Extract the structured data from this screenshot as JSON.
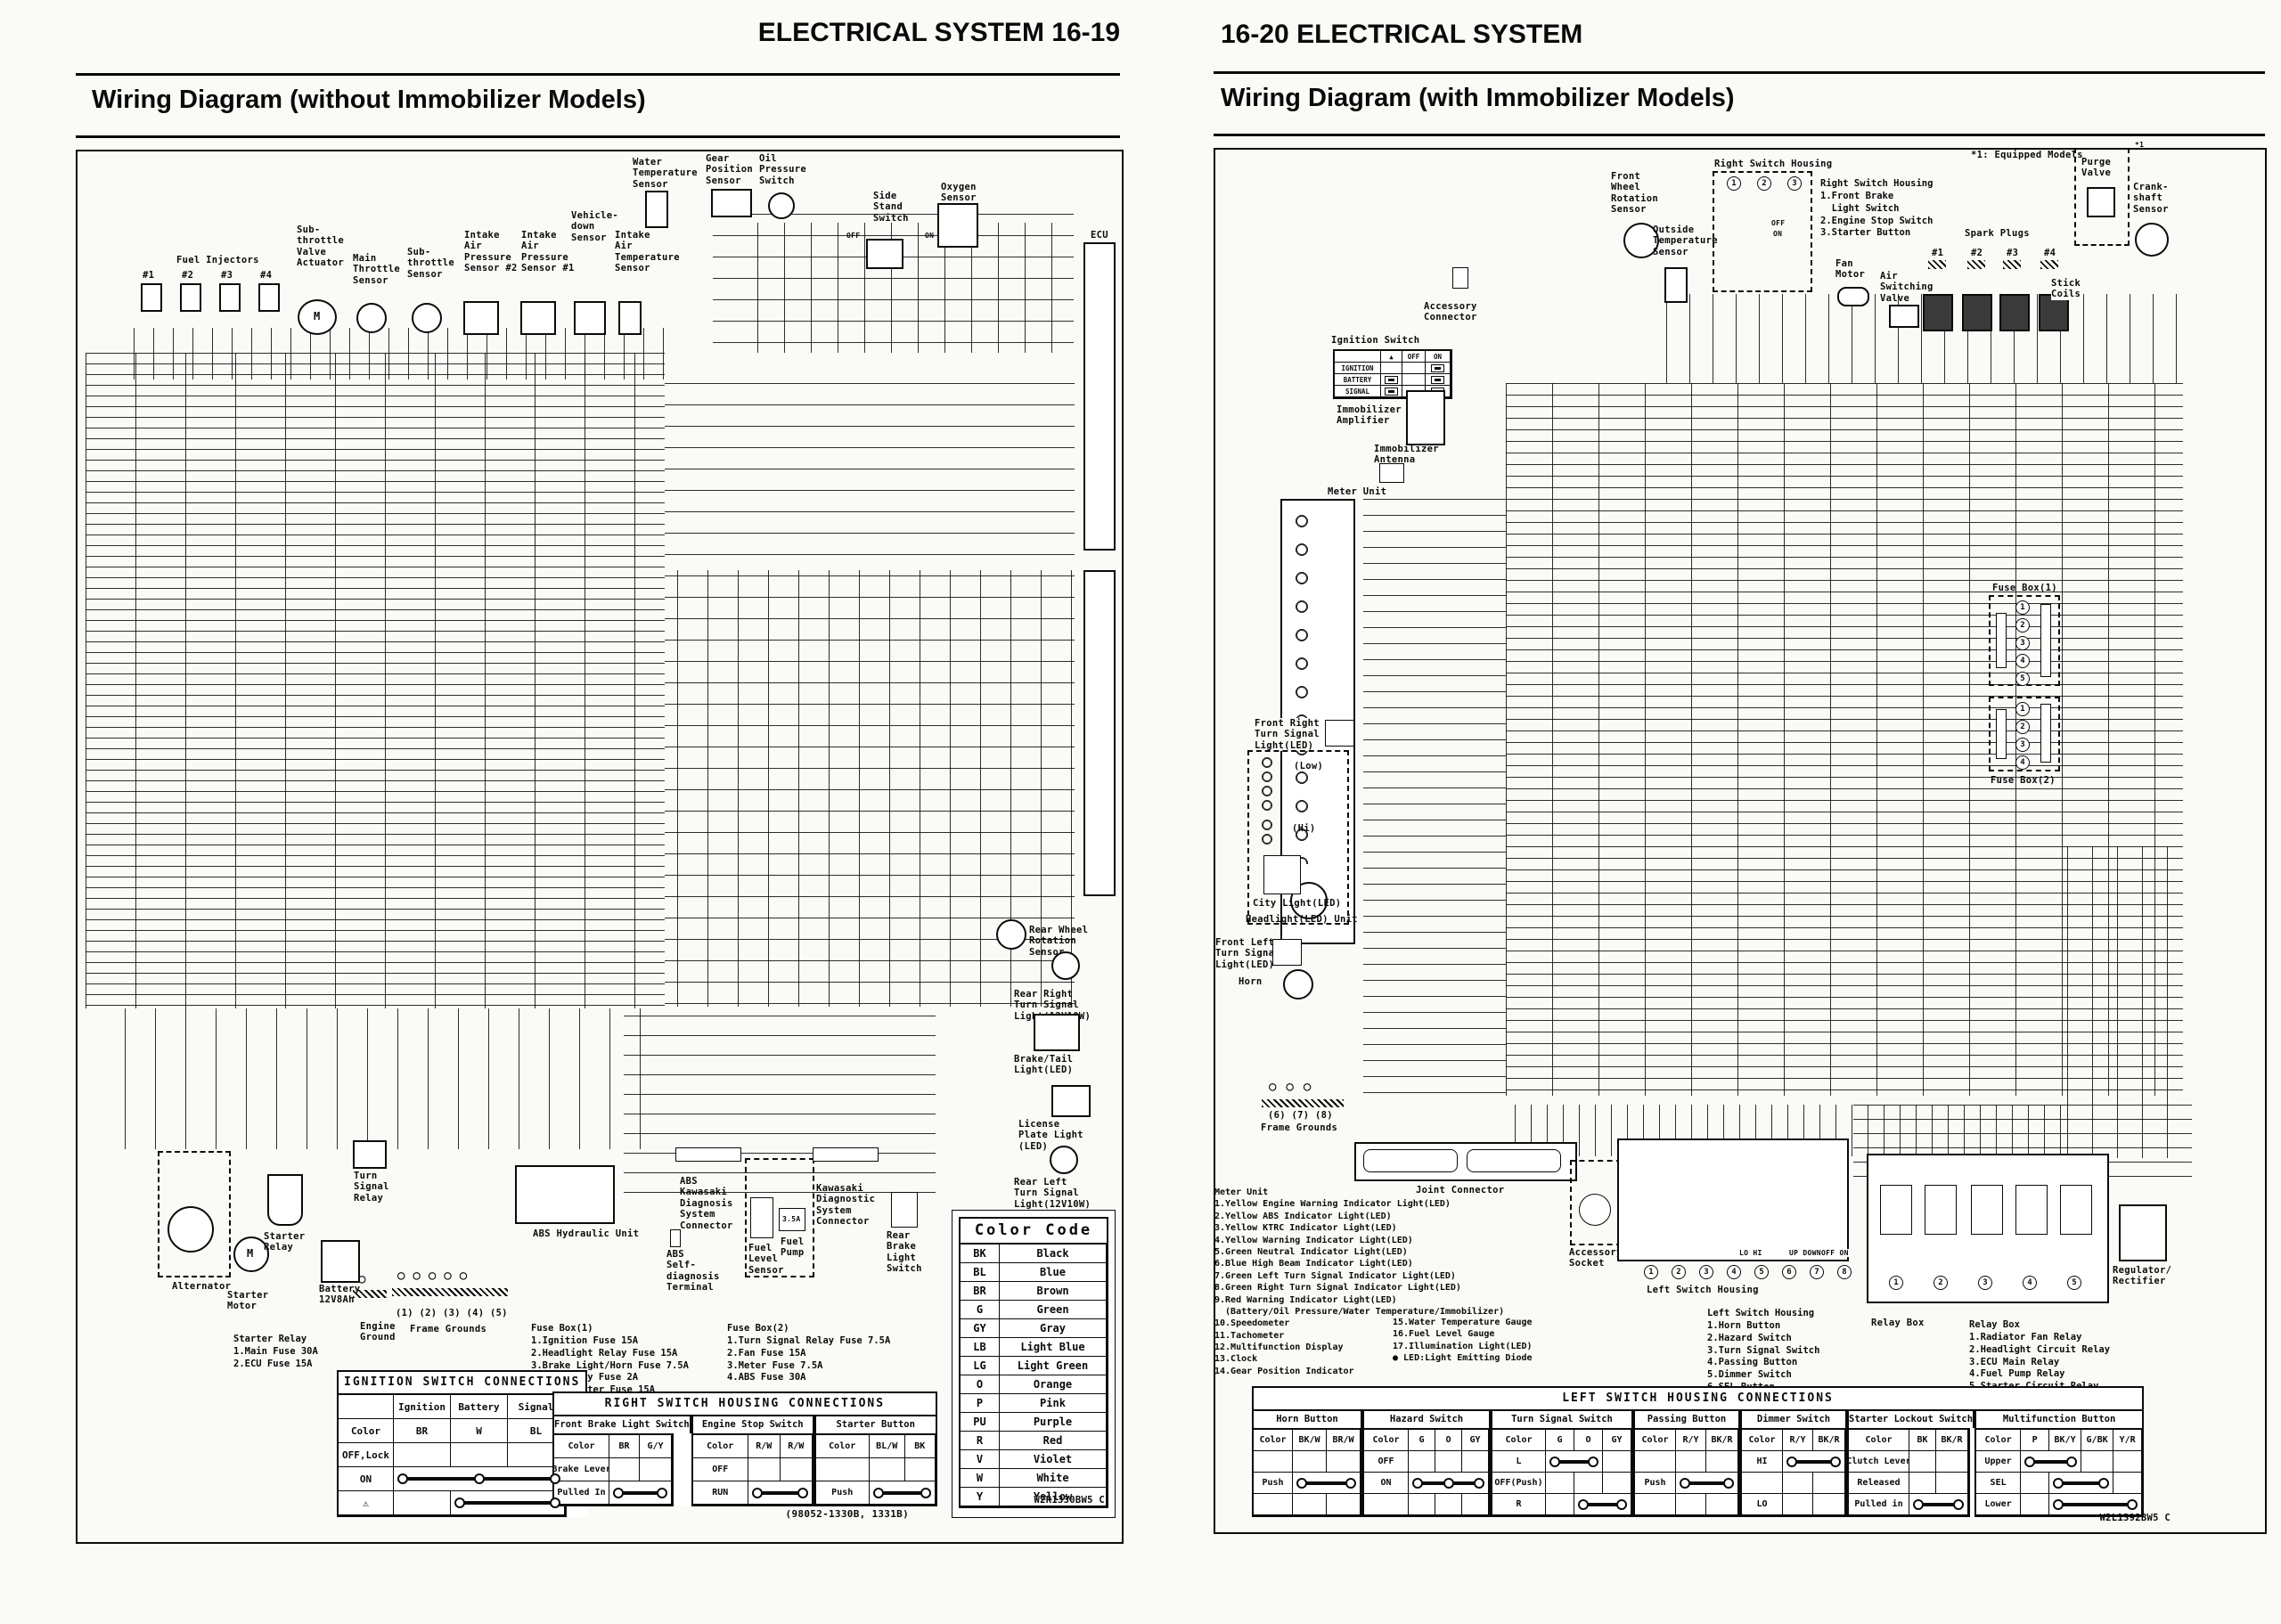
{
  "left": {
    "header": "ELECTRICAL SYSTEM 16-19",
    "title": "Wiring Diagram (without Immobilizer Models)",
    "code": "W2R1330BW5 C",
    "labels": {
      "fuel_injectors": "Fuel Injectors",
      "inj1": "#1",
      "inj2": "#2",
      "inj3": "#3",
      "inj4": "#4",
      "m": "M",
      "sub_throttle_valve_actuator": "Sub-\nthrottle\nValve\nActuator",
      "main_throttle_sensor": "Main\nThrottle\nSensor",
      "sub_throttle_sensor": "Sub-\nthrottle\nSensor",
      "intake_air_pressure_2": "Intake\nAir\nPressure\nSensor #2",
      "intake_air_pressure_1": "Intake\nAir\nPressure\nSensor #1",
      "vehicle_down_sensor": "Vehicle-\ndown\nSensor",
      "intake_air_temp": "Intake\nAir\nTemperature\nSensor",
      "water_temp": "Water\nTemperature\nSensor",
      "gear_position": "Gear\nPosition\nSensor",
      "oil_pressure": "Oil\nPressure\nSwitch",
      "side_stand": "Side\nStand\nSwitch",
      "side_stand_off": "OFF",
      "side_stand_on": "ON",
      "oxygen": "Oxygen\nSensor",
      "ecu": "ECU",
      "rear_wheel_rotation": "Rear Wheel\nRotation\nSensor",
      "rear_right_turn": "Rear Right\nTurn Signal\nLight(12V10W)",
      "brake_tail": "Brake/Tail\nLight(LED)",
      "license_plate": "License\nPlate Light\n(LED)",
      "rear_left_turn": "Rear Left\nTurn Signal\nLight(12V10W)",
      "alternator": "Alternator",
      "starter_motor": "Starter\nMotor",
      "starter_relay": "Starter\nRelay",
      "turn_signal_relay": "Turn\nSignal\nRelay",
      "battery": "Battery\n12V8Ah",
      "engine_ground": "Engine\nGround",
      "frame_ground_nums": "(1)  (2)  (3)  (4)  (5)",
      "frame_grounds": "Frame Grounds",
      "ground_circles5": "○○○○○",
      "ground_circle1": "○",
      "abs_unit": "ABS Hydraulic Unit",
      "abs_kds": "ABS\nKawasaki\nDiagnosis\nSystem\nConnector",
      "abs_terminal": "ABS\nSelf-\ndiagnosis\nTerminal",
      "fuel_level": "Fuel\nLevel\nSensor",
      "fuel_pump": "Fuel\nPump",
      "fuel_pump_fuse": "3.5A",
      "kds": "Kawasaki\nDiagnostic\nSystem\nConnector",
      "rear_brake_switch": "Rear\nBrake\nLight\nSwitch"
    },
    "lists": {
      "starter_relay_fuses": [
        "Starter Relay",
        "1.Main Fuse 30A",
        "2.ECU Fuse 15A"
      ],
      "fuse_box1": [
        "Fuse Box(1)",
        "1.Ignition Fuse 15A",
        "2.Headlight Relay Fuse 15A",
        "3.Brake Light/Horn Fuse 7.5A",
        "4.Accessory Fuse 2A",
        "5.Grip Heater Fuse 15A"
      ],
      "fuse_box2": [
        "Fuse Box(2)",
        "1.Turn Signal Relay Fuse 7.5A",
        "2.Fan Fuse 15A",
        "3.Meter Fuse 7.5A",
        "4.ABS Fuse 30A"
      ]
    },
    "tables": {
      "color_code": {
        "title": "Color Code",
        "rows": [
          [
            "BK",
            "Black"
          ],
          [
            "BL",
            "Blue"
          ],
          [
            "BR",
            "Brown"
          ],
          [
            "G",
            "Green"
          ],
          [
            "GY",
            "Gray"
          ],
          [
            "LB",
            "Light Blue"
          ],
          [
            "LG",
            "Light Green"
          ],
          [
            "O",
            "Orange"
          ],
          [
            "P",
            "Pink"
          ],
          [
            "PU",
            "Purple"
          ],
          [
            "R",
            "Red"
          ],
          [
            "V",
            "Violet"
          ],
          [
            "W",
            "White"
          ],
          [
            "Y",
            "Yellow"
          ]
        ]
      },
      "ignition": {
        "title": "IGNITION SWITCH CONNECTIONS",
        "rows": [
          [
            "",
            "Ignition",
            "Battery",
            "Signal"
          ],
          [
            "Color",
            "BR",
            "W",
            "BL"
          ],
          [
            "OFF,Lock",
            "",
            "",
            ""
          ],
          [
            "ON",
            {
              "c": 3,
              "d": 3
            }
          ],
          [
            "⚠",
            "",
            {
              "c": 2,
              "d": 2
            }
          ]
        ]
      },
      "right_switch": {
        "title": "RIGHT SWITCH HOUSING CONNECTIONS",
        "footer": "(98052-1330B, 1331B)",
        "sections": [
          {
            "name": "Front Brake Light Switch",
            "rows": [
              [
                "Color",
                "BR",
                "G/Y"
              ],
              [
                "Brake Lever",
                "",
                ""
              ],
              [
                "Pulled In",
                {
                  "c": 2,
                  "d": 2
                }
              ]
            ]
          },
          {
            "name": "Engine Stop  Switch",
            "rows": [
              [
                "Color",
                "R/W",
                "R/W"
              ],
              [
                "OFF",
                "",
                ""
              ],
              [
                "RUN",
                {
                  "c": 2,
                  "d": 2
                }
              ]
            ]
          },
          {
            "name": "Starter Button",
            "rows": [
              [
                "Color",
                "BL/W",
                "BK"
              ],
              [
                "",
                "",
                ""
              ],
              [
                "Push",
                {
                  "c": 2,
                  "d": 2
                }
              ]
            ]
          }
        ]
      }
    }
  },
  "right": {
    "header": "16-20 ELECTRICAL SYSTEM",
    "title": "Wiring Diagram (with Immobilizer Models)",
    "code": "W2L1392BW5 C",
    "labels": {
      "front_wheel_rotation": "Front\nWheel\nRotation\nSensor",
      "outside_temp": "Outside\nTemperature\nSensor",
      "right_switch_housing_box": "Right Switch Housing",
      "rsh_off": "OFF",
      "rsh_on": "ON",
      "fan_motor": "Fan\nMotor",
      "air_switching_valve": "Air\nSwitching\nValve",
      "spark_plugs": "Spark Plugs",
      "sp1": "#1",
      "sp2": "#2",
      "sp3": "#3",
      "sp4": "#4",
      "stick_coils": "Stick\nCoils",
      "equipped_models": "*1: Equipped Models",
      "purge_valve": "Purge\nValve",
      "purge_ref": "*1",
      "crankshaft": "Crank-\nshaft\nSensor",
      "accessory_connector": "Accessory\nConnector",
      "ignition_switch": "Ignition Switch",
      "immobilizer_amp": "Immobilizer\nAmplifier",
      "immobilizer_ant": "Immobilizer\nAntenna",
      "meter_unit": "Meter Unit",
      "front_right_turn": "Front Right\nTurn Signal\nLight(LED)",
      "low": "(Low)",
      "hi": "(Hi)",
      "city_light": "City Light(LED)",
      "headlight_unit": "Headlight(LED) Unit",
      "front_left_turn": "Front Left\nTurn Signal\nLight(LED)",
      "horn": "Horn",
      "frame_ground_nums": "(6)  (7)  (8)",
      "frame_grounds": "Frame Grounds",
      "ground_circles3": "○○○",
      "joint_connector": "Joint Connector",
      "accessory_socket": "Accessory\nSocket",
      "fuse_box1": "Fuse Box(1)",
      "fuse_box2": "Fuse Box(2)",
      "regulator": "Regulator/\nRectifier",
      "relay_box": "Relay Box",
      "left_switch_housing_label": "Left Switch Housing",
      "lo_hi": "LO  HI",
      "up_down": "UP DOWN",
      "off_on": "OFF ON"
    },
    "lists": {
      "right_switch_housing": [
        "Right Switch Housing",
        "1.Front Brake",
        "  Light Switch",
        "2.Engine Stop Switch",
        "3.Starter Button"
      ],
      "meter_col1": [
        "Meter Unit",
        "1.Yellow Engine Warning Indicator Light(LED)",
        "2.Yellow ABS Indicator Light(LED)",
        "3.Yellow KTRC Indicator Light(LED)",
        "4.Yellow Warning Indicator Light(LED)",
        "5.Green Neutral Indicator Light(LED)",
        "6.Blue High Beam Indicator Light(LED)",
        "7.Green Left Turn Signal Indicator Light(LED)",
        "8.Green Right Turn Signal Indicator Light(LED)",
        "9.Red Warning Indicator Light(LED)",
        "  (Battery/Oil Pressure/Water Temperature/Immobilizer)",
        "10.Speedometer",
        "11.Tachometer",
        "12.Multifunction Display",
        "13.Clock",
        "14.Gear Position Indicator"
      ],
      "meter_col2": [
        "15.Water Temperature Gauge",
        "16.Fuel Level Gauge",
        "17.Illumination Light(LED)",
        "● LED:Light Emitting Diode"
      ],
      "left_switch_housing": [
        "Left Switch Housing",
        "1.Horn Button",
        "2.Hazard Switch",
        "3.Turn Signal Switch",
        "4.Passing Button",
        "5.Dimmer Switch",
        "6.SEL Button",
        "7.Upper and Lower Button",
        "8.Starter Lockout Switch"
      ],
      "relay_box": [
        "Relay Box",
        "1.Radiator Fan Relay",
        "2.Headlight Circuit Relay",
        "3.ECU Main Relay",
        "4.Fuel Pump Relay",
        "5.Starter Circuit Relay"
      ],
      "rsh_nums": [
        "1",
        "2",
        "3"
      ],
      "lsh_nums": [
        "1",
        "2",
        "3",
        "4",
        "5",
        "6",
        "7",
        "8"
      ],
      "relay_nums": [
        "1",
        "2",
        "3",
        "4",
        "5"
      ],
      "fb1_nums": [
        "1",
        "2",
        "3",
        "4",
        "5"
      ],
      "fb2_nums": [
        "1",
        "2",
        "3",
        "4"
      ]
    },
    "tables": {
      "ignition_mini": {
        "rows": [
          [
            "",
            "▲",
            "OFF",
            "ON"
          ],
          [
            "IGNITION",
            "",
            "",
            {
              "p": 1
            }
          ],
          [
            "BATTERY",
            {
              "p": 1
            },
            "",
            {
              "p": 1
            }
          ],
          [
            "SIGNAL",
            {
              "p": 1
            },
            "",
            {
              "p": 1
            }
          ]
        ]
      },
      "left_switch": {
        "title": "LEFT SWITCH HOUSING CONNECTIONS",
        "sections": [
          {
            "name": "Horn Button",
            "rows": [
              [
                "Color",
                "BK/W",
                "BR/W"
              ],
              [
                "",
                "",
                ""
              ],
              [
                "Push",
                {
                  "c": 2,
                  "d": 2
                }
              ],
              [
                "",
                "",
                ""
              ]
            ]
          },
          {
            "name": "Hazard Switch",
            "rows": [
              [
                "Color",
                "G",
                "O",
                "GY"
              ],
              [
                "OFF",
                "",
                "",
                ""
              ],
              [
                "ON",
                {
                  "c": 3,
                  "d": 3
                }
              ],
              [
                "",
                "",
                "",
                ""
              ]
            ]
          },
          {
            "name": "Turn Signal Switch",
            "rows": [
              [
                "Color",
                "G",
                "O",
                "GY"
              ],
              [
                "L",
                {
                  "c": 2,
                  "d": 2
                },
                ""
              ],
              [
                "OFF(Push)",
                "",
                "",
                ""
              ],
              [
                "R",
                "",
                {
                  "c": 2,
                  "d": 2
                }
              ]
            ]
          },
          {
            "name": "Passing Button",
            "rows": [
              [
                "Color",
                "R/Y",
                "BK/R"
              ],
              [
                "",
                "",
                ""
              ],
              [
                "Push",
                {
                  "c": 2,
                  "d": 2
                }
              ],
              [
                "",
                "",
                ""
              ]
            ]
          },
          {
            "name": "Dimmer Switch",
            "rows": [
              [
                "Color",
                "R/Y",
                "BK/R"
              ],
              [
                "HI",
                {
                  "c": 2,
                  "d": 2
                }
              ],
              [
                "",
                "",
                ""
              ],
              [
                "LO",
                "",
                ""
              ]
            ]
          },
          {
            "name": "Starter Lockout Switch",
            "rows": [
              [
                "Color",
                "BK",
                "BK/R"
              ],
              [
                "Clutch Lever",
                "",
                ""
              ],
              [
                "Released",
                "",
                ""
              ],
              [
                "Pulled in",
                {
                  "c": 2,
                  "d": 2
                }
              ]
            ]
          },
          {
            "name": "Multifunction Button",
            "rows": [
              [
                "Color",
                "P",
                "BK/Y",
                "G/BK",
                "Y/R"
              ],
              [
                "Upper",
                {
                  "c": 2,
                  "d": 2
                },
                "",
                ""
              ],
              [
                "SEL",
                "",
                {
                  "c": 2,
                  "d": 2
                },
                ""
              ],
              [
                "Lower",
                "",
                {
                  "c": 3,
                  "d": 2
                }
              ]
            ]
          }
        ]
      }
    }
  }
}
